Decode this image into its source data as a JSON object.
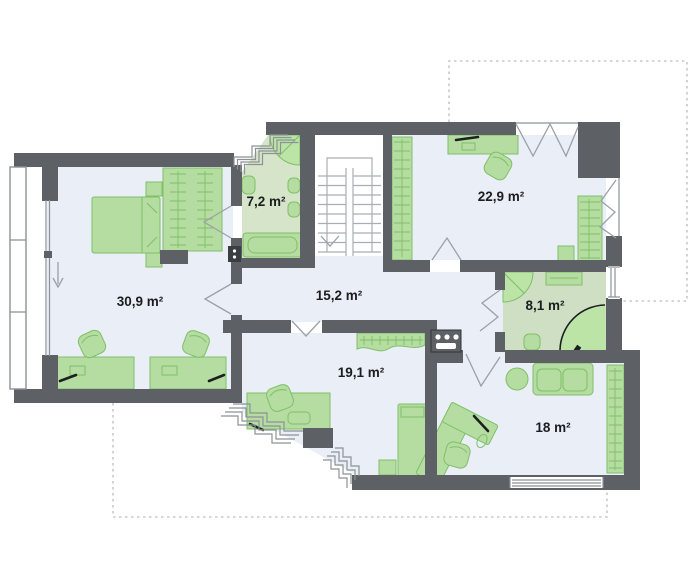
{
  "page": {
    "background": "#ffffff",
    "description": "architectural floor plan of an upper storey"
  },
  "colors": {
    "wall": "#5d6064",
    "floor": "#e9eef7",
    "bath_floor": "#d6e5c9",
    "bath_floor_dark": "#cfdfc3",
    "furniture": "#b6dda1",
    "furniture_stroke": "#7fbf68",
    "shower": "#bce4a7",
    "stair_line": "#aaaeb4",
    "door_line": "#9ca1a7",
    "window_frame": "#8d9297",
    "dashed_outline": "#c6c9cc",
    "ink": "#1d2022",
    "label_text": "#1b1d1f",
    "appliance": "#4a4d50"
  },
  "rooms": [
    {
      "name": "bedroom-left",
      "area_label": "30,9 m²"
    },
    {
      "name": "bathroom-top",
      "area_label": "7,2 m²"
    },
    {
      "name": "hall",
      "area_label": "15,2 m²"
    },
    {
      "name": "room-top-right",
      "area_label": "22,9 m²"
    },
    {
      "name": "bathroom-right",
      "area_label": "8,1 m²"
    },
    {
      "name": "room-bottom-middle",
      "area_label": "19,1 m²"
    },
    {
      "name": "room-bottom-right",
      "area_label": "18 m²"
    }
  ],
  "symbols": [
    "bed",
    "wardrobe-with-hangers",
    "desk",
    "office-chair",
    "sofa",
    "round-table",
    "bathtub",
    "corner-shower",
    "toilet",
    "sink",
    "staircase-double-flight",
    "down-arrow",
    "folding-door",
    "door-swing",
    "corner-window-steps",
    "balcony-strip",
    "roof-outline-dashed",
    "ventilation-box",
    "appliance-box"
  ]
}
